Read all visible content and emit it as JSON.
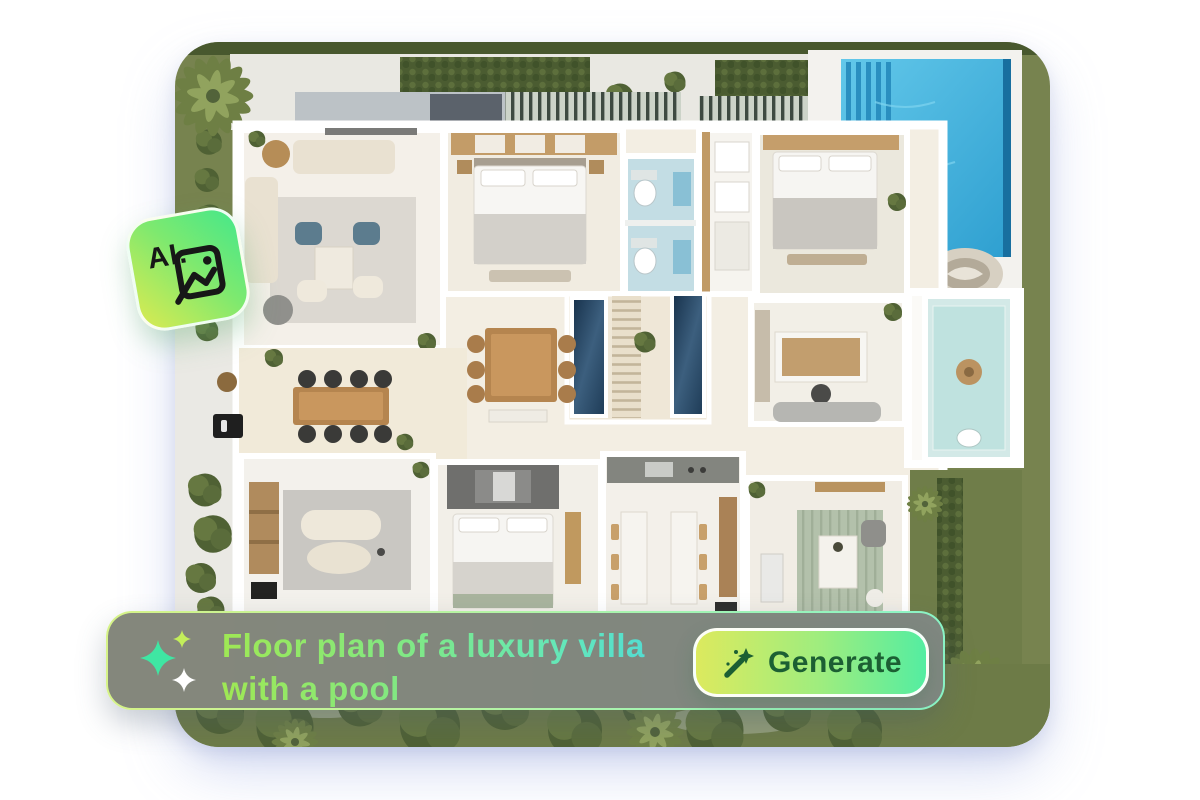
{
  "ai_badge": {
    "label": "AI.",
    "icon": "ai-image-badge-icon",
    "gradient_start": "#cdea55",
    "gradient_end": "#4ce887"
  },
  "prompt_bar": {
    "icon": "sparkles-icon",
    "line1": "Floor plan of a luxury villa",
    "line2": "with a pool",
    "background": "#7e7e7b",
    "border_gradient": [
      "#d6f388",
      "#8af3c6"
    ],
    "text_gradient": [
      "#9fe854",
      "#7fe887",
      "#49d5e0"
    ]
  },
  "generate_button": {
    "label": "Generate",
    "icon": "magic-wand-icon",
    "text_color": "#1c5f33",
    "gradient": [
      "#dcea5e",
      "#54eda1"
    ]
  },
  "floor_plan_image": {
    "alt": "top-down-floor-plan-of-luxury-villa-with-pool",
    "colors": {
      "pool": "#45b5e3",
      "grass": "#76824e",
      "villa_floor": "#f2ecdf",
      "deck_white": "#f3f2ee",
      "stair_glass": "#24425e"
    }
  }
}
